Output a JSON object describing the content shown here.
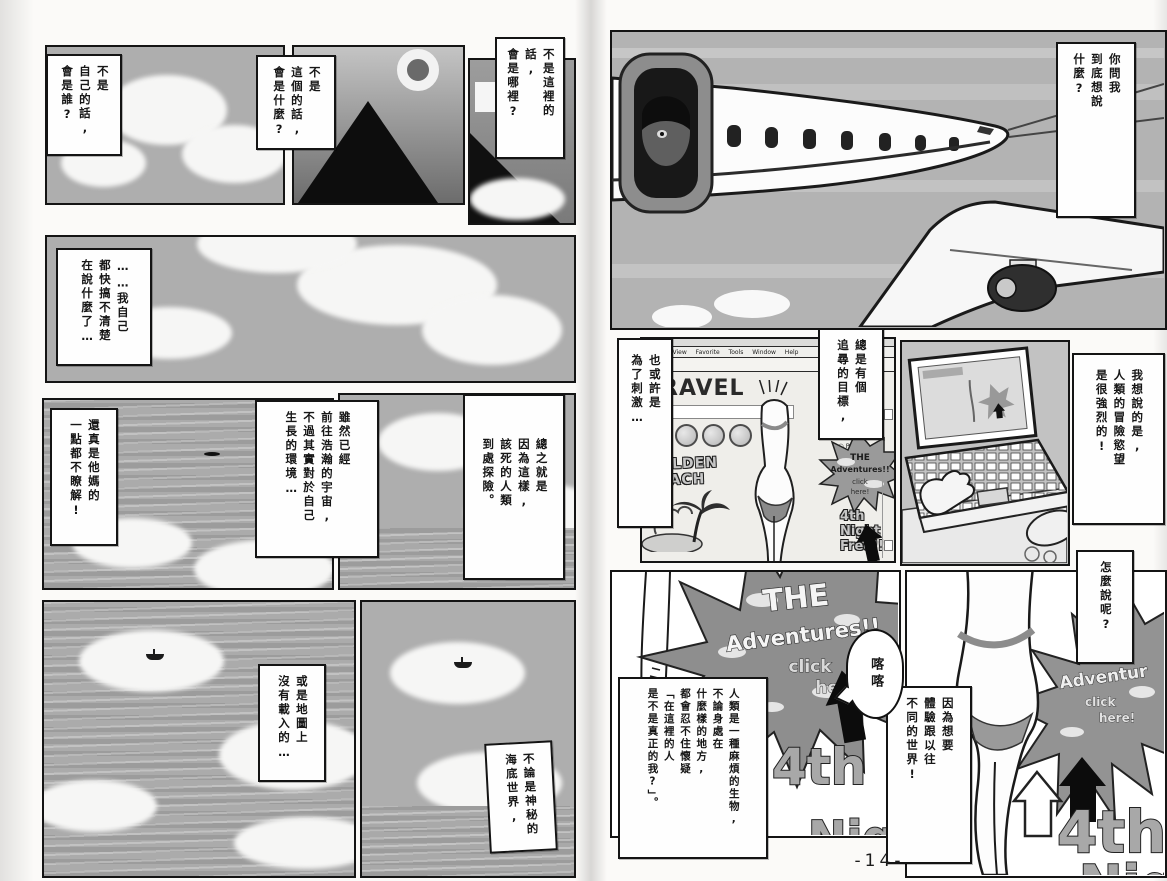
{
  "page_number": "-14-",
  "left_page": {
    "b1": "不是\n自己的話,\n會是誰?",
    "b2": "不是\n這個的話,\n會是什麼?",
    "b3": "不是這裡的話,\n會是哪裡?",
    "b4": "……我自己\n都快搞不清楚\n在說什麼了…",
    "b5": "還真是他媽的\n一點都不瞭解!",
    "b6": "雖然已經\n前往浩瀚的宇宙,\n不過其實對於自己\n生長的環境…",
    "b7": "總之就是\n因為這樣,\n該死的人類\n到處探險。",
    "b8": "或是地圖上\n沒有載入的…",
    "b9": "不論是神秘的\n海底世界,"
  },
  "right_page": {
    "b10": "你問我\n到底想說\n什麼?",
    "b11": "也或許是\n為了刺激…",
    "b12": "總是有個\n追尋的目標,",
    "b13": "我想說的是,\n人類的冒險慾望\n是很強烈的!",
    "b14": "人類是一種麻煩的生物,\n不論身處在\n什麼樣的地方,\n都會忍不住懷疑\n「在這裡的人\n是不是真正的我?」。",
    "b15": "怎麼說呢?",
    "b16": "因為想要\n體驗跟以往\n不同的世界!",
    "sound_effect": "喀喀",
    "browser": {
      "menu": "Edit View Favorite Tools Window Help",
      "play_icon": "▶",
      "close_icon": "✕",
      "site_title": "TRAVEL",
      "beach_label": "GOLDEN\nBEACH",
      "list_item_1": "○ MO",
      "list_item_2": "○ JA",
      "list_item_3": "○ PA",
      "ad_the": "THE",
      "ad_adventures": "Adventures!!",
      "ad_click": "click",
      "ad_here": "here!",
      "promo": "4th\nNight\nFree!!"
    },
    "big_ad": {
      "the": "THE",
      "adventures": "Adventures!!",
      "click": "click",
      "here": "here",
      "night1": "4th",
      "night2": "Night"
    },
    "right_ad": {
      "the": "E",
      "adventures": "Adventur",
      "click": "click",
      "here": "here!",
      "night1": "4th",
      "night2": "Night"
    }
  }
}
